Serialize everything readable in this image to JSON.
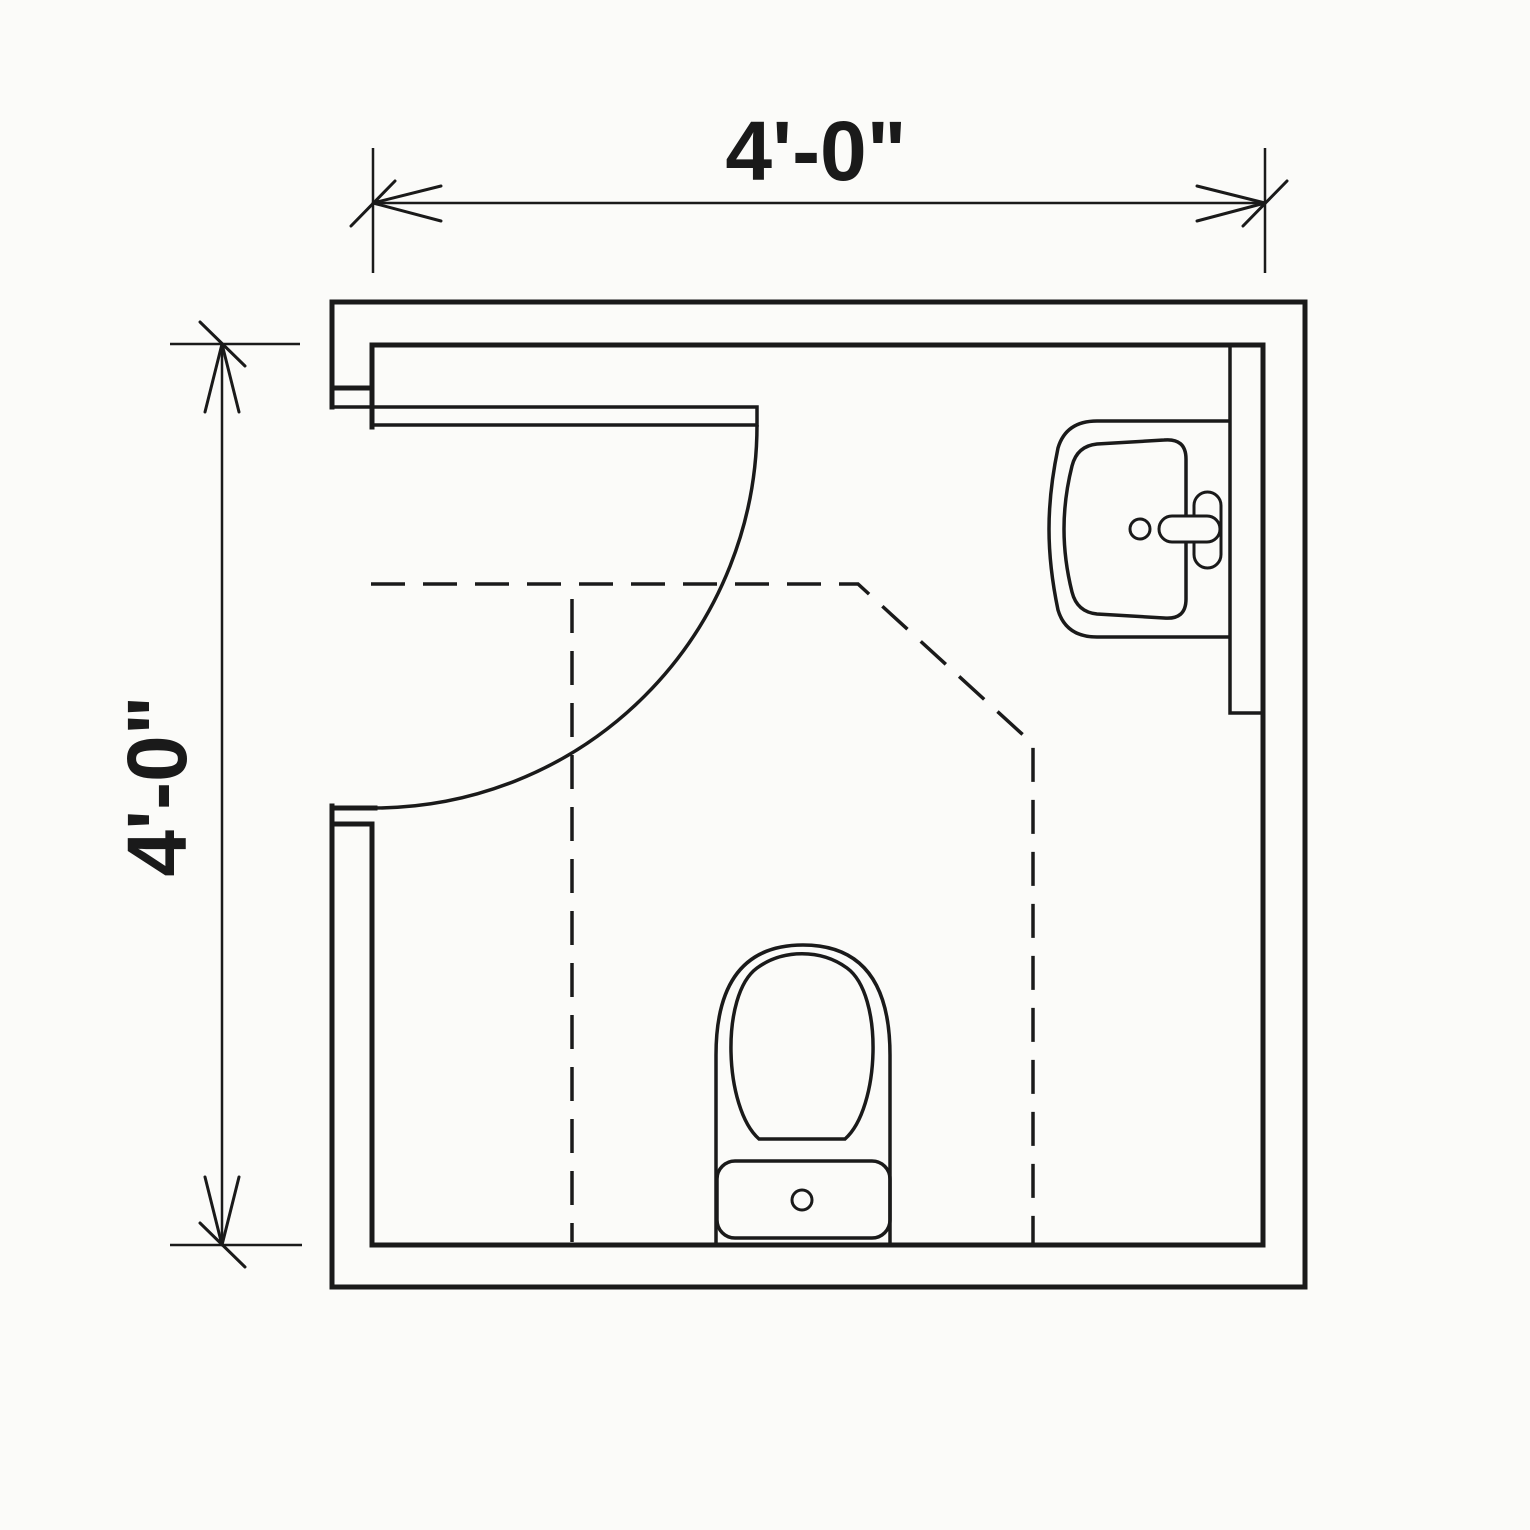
{
  "colors": {
    "line": "#1a1a1a",
    "background": "#fbfbf9"
  },
  "dimensions": {
    "top": {
      "label": "4'-0\""
    },
    "left": {
      "label": "4'-0\""
    }
  },
  "fixtures": [
    {
      "name": "door",
      "symbol": "swing-door-90"
    },
    {
      "name": "sink",
      "symbol": "wall-hung-lavatory"
    },
    {
      "name": "toilet",
      "symbol": "tank-toilet"
    }
  ],
  "clearances": {
    "style": "dashed-outline"
  }
}
